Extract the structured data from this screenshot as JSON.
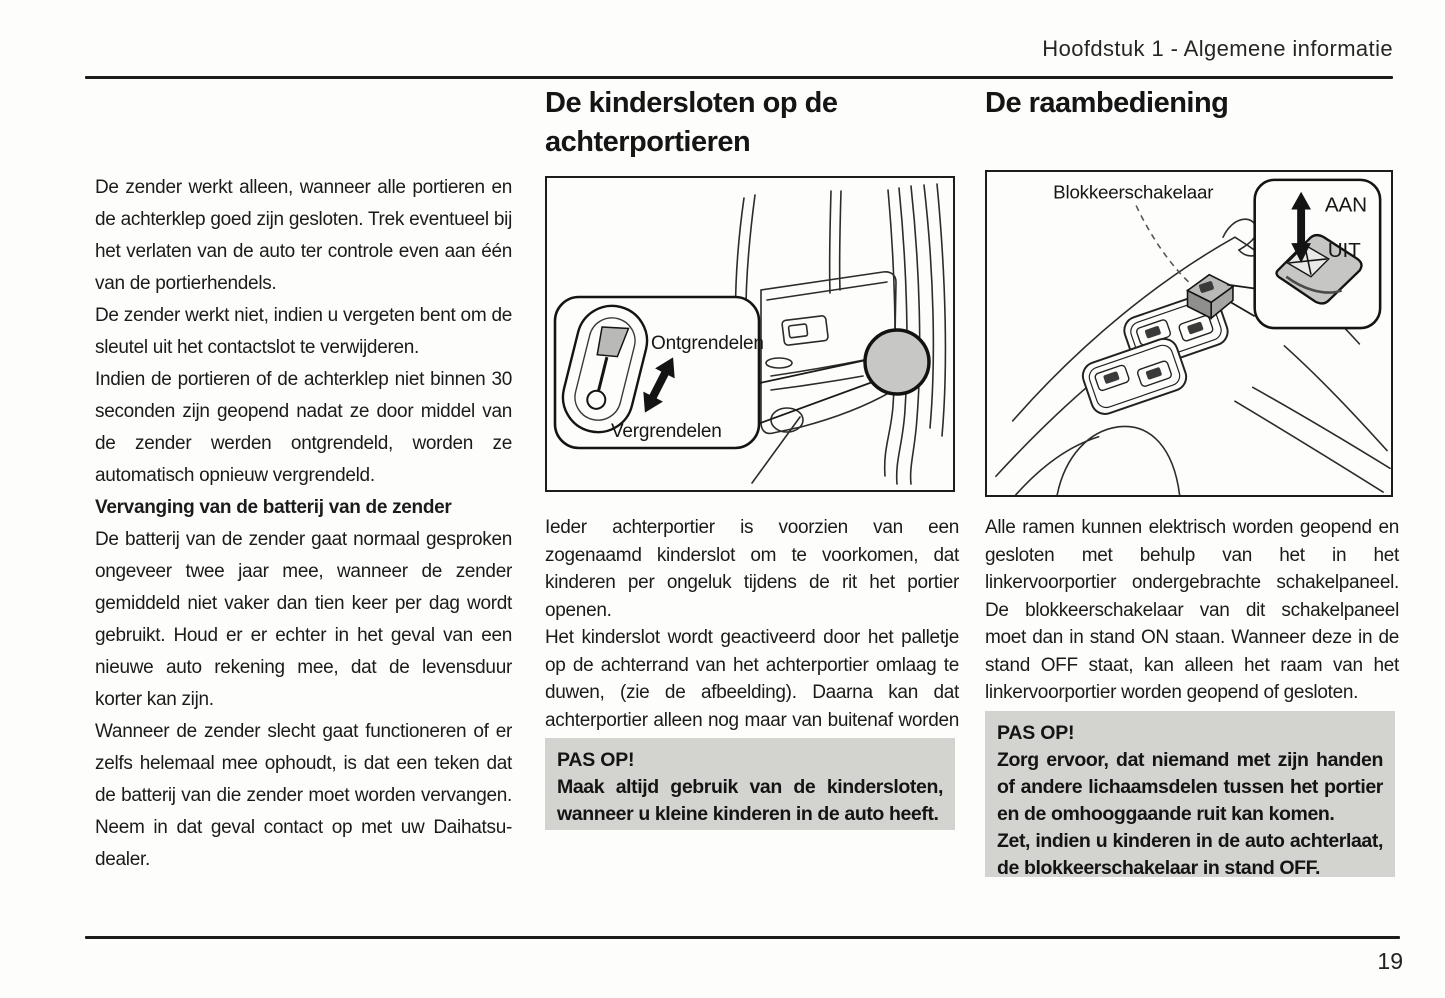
{
  "header": {
    "chapter_title": "Hoofdstuk 1 - Algemene informatie",
    "page_number": "19"
  },
  "left_column": {
    "para1": "De zender werkt alleen, wanneer alle portieren en de achterklep goed zijn gesloten. Trek eventueel bij het verlaten van de auto ter controle even aan één van de portierhendels.",
    "para2": "De zender werkt niet, indien u vergeten bent om de sleutel uit het contactslot te verwijderen.",
    "para3": "Indien de portieren of de achterklep niet binnen 30 seconden zijn geopend nadat ze door middel van de zender werden ontgrendeld, worden ze automatisch opnieuw vergrendeld.",
    "subheading": "Vervanging van de batterij van de zender",
    "para4": "De batterij van de zender gaat normaal gesproken ongeveer twee jaar mee, wanneer de zender gemiddeld niet vaker dan tien keer per dag wordt gebruikt. Houd er er echter in het geval van een nieuwe auto rekening mee, dat de levensduur korter kan zijn.",
    "para5": "Wanneer de zender slecht gaat functioneren of er zelfs helemaal mee ophoudt, is dat een teken dat de batterij van die zender moet worden vervangen. Neem in dat geval contact op met uw Daihatsu-dealer."
  },
  "middle_column": {
    "heading": "De kindersloten op de achterportieren",
    "figure_labels": {
      "unlock": "Ontgrendelen",
      "lock": "Vergrendelen"
    },
    "para1": "Ieder achterportier is voorzien van een zogenaamd kinderslot om te voorkomen, dat kinderen per ongeluk tijdens de rit het portier openen.",
    "para2": "Het kinderslot wordt geactiveerd door het palletje op de achterrand van het achterportier omlaag te duwen, (zie de afbeelding). Daarna kan dat achterportier alleen nog maar van buitenaf worden geopend.",
    "warning": {
      "title": "PAS OP!",
      "body": "Maak altijd gebruik van de kindersloten, wanneer u kleine kinderen in de auto heeft."
    }
  },
  "right_column": {
    "heading": "De raambediening",
    "figure_labels": {
      "switch": "Blokkeerschakelaar",
      "on": "AAN",
      "off": "UIT"
    },
    "para1": "Alle ramen kunnen elektrisch worden geopend en gesloten met behulp van het in het linkervoorportier ondergebrachte schakelpaneel. De blokkeerschakelaar van dit schakelpaneel moet dan in stand ON staan. Wanneer deze in de stand OFF staat, kan alleen het raam van het linkervoorportier worden geopend of gesloten.",
    "warning": {
      "title": "PAS OP!",
      "body1": "Zorg ervoor, dat niemand met zijn handen of andere lichaamsdelen tussen het portier en de omhooggaande ruit kan komen.",
      "body2": "Zet, indien u kinderen in de auto achterlaat, de blokkeerschakelaar in stand OFF."
    }
  },
  "colors": {
    "text": "#1b1b1b",
    "warning_background": "#d3d3d0",
    "figure_shade_gray": "#c7c7c5",
    "rule": "#1c1c1c"
  }
}
